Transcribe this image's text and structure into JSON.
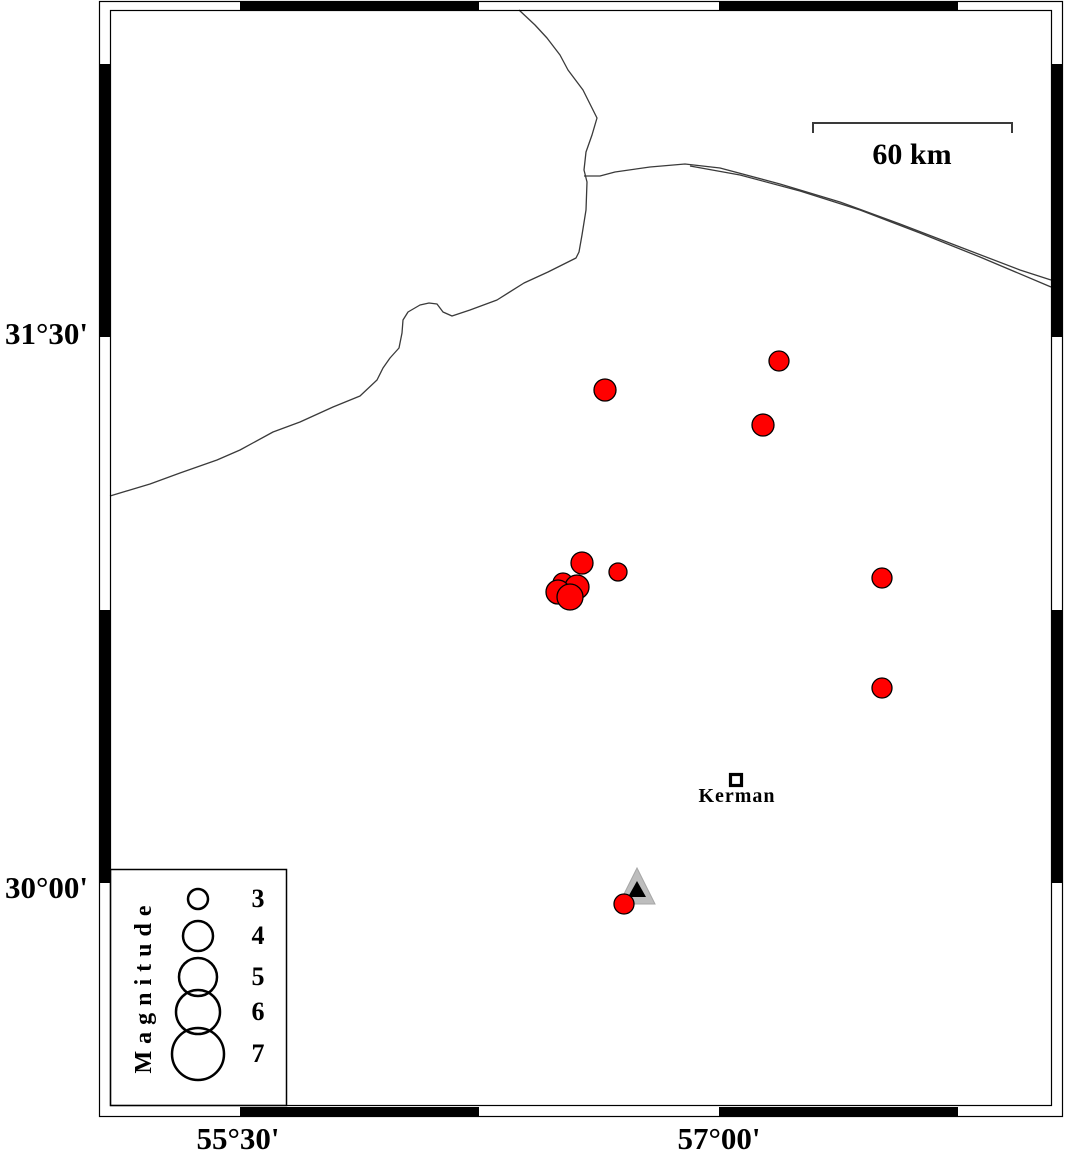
{
  "colors": {
    "earthquake_fill": "#ff0000",
    "marker_outline": "#000000",
    "station_outer": "#bdbdbd",
    "station_inner": "#000000",
    "border_line": "#3a3a3a"
  },
  "axis": {
    "left": [
      {
        "text": "31°30'"
      },
      {
        "text": "30°00'"
      }
    ],
    "bottom": [
      {
        "text": "55°30'"
      },
      {
        "text": "57°00'"
      }
    ]
  },
  "scale_bar": {
    "label": "60 km"
  },
  "city": {
    "label": "Kerman",
    "x": 736,
    "y": 780
  },
  "station": {
    "x": 637,
    "y": 887,
    "shape": "triangle"
  },
  "legend": {
    "title": "Magnitude",
    "cx": 198,
    "label_x": 258,
    "entries": [
      {
        "label": "3",
        "radius": 10,
        "y": 899
      },
      {
        "label": "4",
        "radius": 15,
        "y": 936
      },
      {
        "label": "5",
        "radius": 19,
        "y": 977
      },
      {
        "label": "6",
        "radius": 22,
        "y": 1012
      },
      {
        "label": "7",
        "radius": 26,
        "y": 1054
      }
    ]
  },
  "earthquakes": [
    {
      "x": 605,
      "y": 390,
      "r": 11,
      "lon": 56.64,
      "lat": 31.35
    },
    {
      "x": 779,
      "y": 361,
      "r": 10,
      "lon": 57.19,
      "lat": 31.43
    },
    {
      "x": 763,
      "y": 425,
      "r": 11,
      "lon": 57.14,
      "lat": 31.26
    },
    {
      "x": 882,
      "y": 578,
      "r": 10,
      "lon": 57.51,
      "lat": 30.84
    },
    {
      "x": 882,
      "y": 688,
      "r": 10,
      "lon": 57.51,
      "lat": 30.54
    },
    {
      "x": 582,
      "y": 563,
      "r": 11,
      "lon": 56.57,
      "lat": 30.88
    },
    {
      "x": 618,
      "y": 572,
      "r": 9,
      "lon": 56.68,
      "lat": 30.85
    },
    {
      "x": 563,
      "y": 583,
      "r": 10,
      "lon": 56.51,
      "lat": 30.82
    },
    {
      "x": 577,
      "y": 587,
      "r": 12,
      "lon": 56.56,
      "lat": 30.81
    },
    {
      "x": 558,
      "y": 592,
      "r": 12,
      "lon": 56.5,
      "lat": 30.8
    },
    {
      "x": 570,
      "y": 597,
      "r": 13,
      "lon": 56.53,
      "lat": 30.79
    },
    {
      "x": 624,
      "y": 904,
      "r": 10,
      "lon": 56.7,
      "lat": 29.94
    }
  ]
}
